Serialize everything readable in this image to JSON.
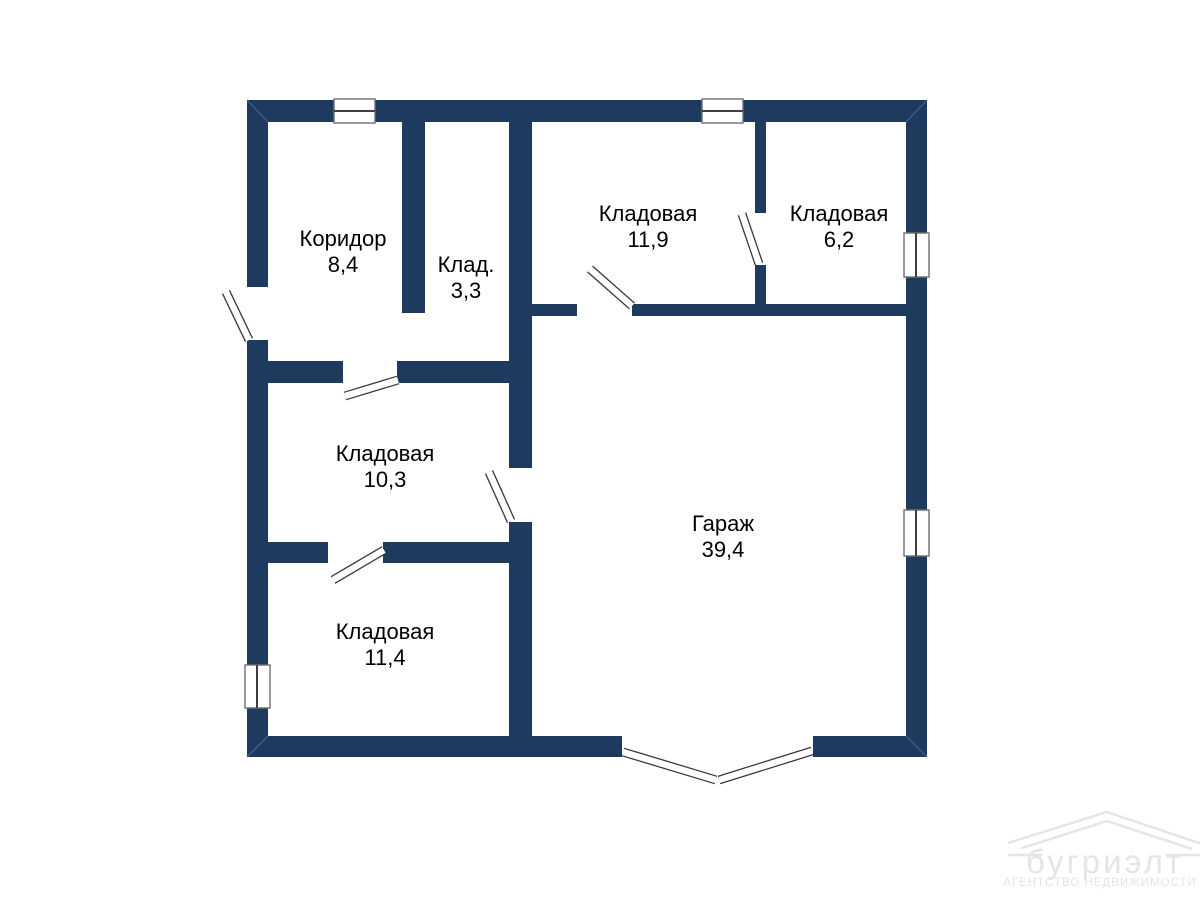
{
  "colors": {
    "wall": "#1e3a5f",
    "label": "#000000",
    "watermark": "#e5e5e5"
  },
  "rooms": [
    {
      "name": "Коридор",
      "area": "8,4"
    },
    {
      "name": "Клад.",
      "area": "3,3"
    },
    {
      "name": "Кладовая",
      "area": "11,9"
    },
    {
      "name": "Кладовая",
      "area": "6,2"
    },
    {
      "name": "Кладовая",
      "area": "10,3"
    },
    {
      "name": "Гараж",
      "area": "39,4"
    },
    {
      "name": "Кладовая",
      "area": "11,4"
    }
  ],
  "watermark": {
    "brand": "бугриэлт",
    "tagline": "АГЕНТСТВО НЕДВИЖИМОСТИ"
  }
}
